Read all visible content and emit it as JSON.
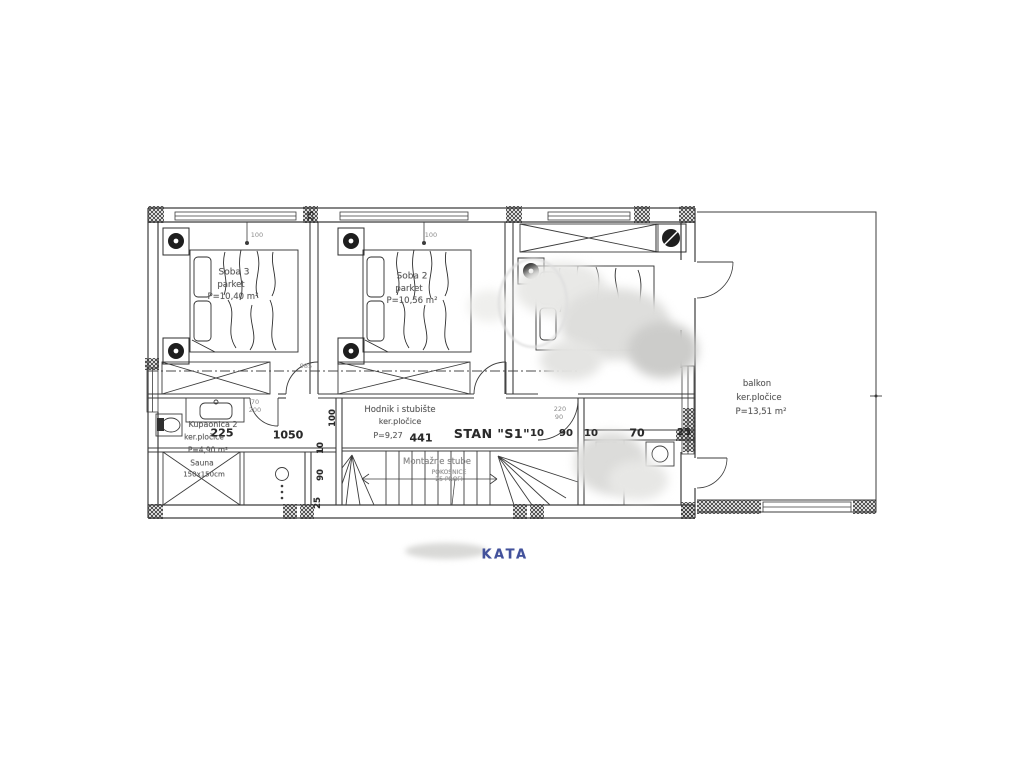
{
  "plan": {
    "apartment_label": "STAN \"S1\"",
    "sheet_title": "KATA",
    "rooms": {
      "soba3": {
        "name": "Soba 3",
        "floor": "parket",
        "area": "P=10,40 m²"
      },
      "soba2": {
        "name": "Soba 2",
        "floor": "parket",
        "area": "P=10,56 m²"
      },
      "kupaonica2": {
        "name": "Kupaonica 2",
        "floor": "ker.pločice",
        "area": "P=4,90 m²",
        "sauna": "Sauna",
        "sauna_size": "150x150cm"
      },
      "hodnik": {
        "name": "Hodnik i stubište",
        "floor": "ker.pločice",
        "area": "P=9,27"
      },
      "stube": {
        "name": "Montažne stube",
        "note_line1": "POKOSNICE",
        "note_line2": "25 PROFI"
      },
      "balkon": {
        "name": "balkon",
        "floor": "ker.pločice",
        "area": "P=13,51 m²"
      }
    },
    "dimensions": {
      "d100a": "100",
      "d100b": "100",
      "d25_top": "25",
      "d225": "225",
      "d1050": "1050",
      "d441": "441",
      "d10a": "10",
      "d90a": "90",
      "d10b": "10",
      "d70": "70",
      "d25r": "25",
      "v100": "100",
      "v10": "10",
      "v90": "90",
      "v25": "25",
      "d985": "985",
      "door_bath_top": "70",
      "door_bath_bottom": "200",
      "door_room_top": "220",
      "door_room_bottom": "90"
    },
    "colors": {
      "line": "#3c3c3c",
      "title_blue": "#42519b"
    }
  }
}
